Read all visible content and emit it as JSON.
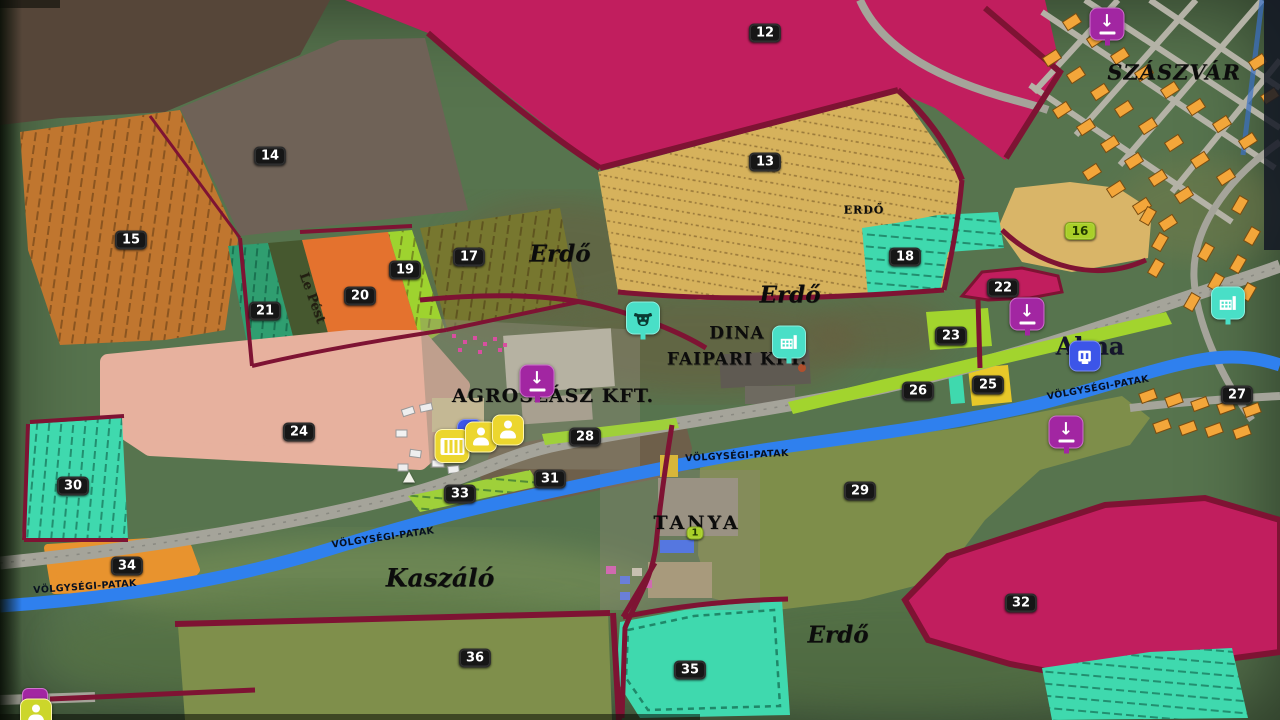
{
  "map": {
    "town": "SZÁSZVÁR",
    "labels": {
      "erdo_caps": "ERDŐ",
      "erdo": "Erdő",
      "dina_line1": "DINA",
      "dina_line2": "FAIPARI KFT.",
      "agroszasz": "AGROSZÁSZ KFT.",
      "alma": "Alma",
      "tanya": "TANYA",
      "kaszalo": "Kaszáló",
      "lepest": "Le Pést",
      "stream": "VÖLGYSÉGI-PATAK"
    },
    "badges": {
      "f12": "12",
      "f13": "13",
      "f14": "14",
      "f15": "15",
      "f16": "16",
      "f17": "17",
      "f18": "18",
      "f19": "19",
      "f20": "20",
      "f21": "21",
      "f22": "22",
      "f23": "23",
      "f24": "24",
      "f25": "25",
      "f26": "26",
      "f27": "27",
      "f28": "28",
      "f29": "29",
      "f30": "30",
      "f31": "31",
      "f32": "32",
      "f33": "33",
      "f34": "34",
      "f35": "35",
      "f36": "36",
      "farm1": "1"
    },
    "glyphs": {
      "sell_arrow": "↓"
    },
    "icons": {
      "sell_point": "purple-sell-point",
      "cow_pasture": "cow-pasture",
      "factory": "factory-sawmill",
      "production": "blue-production",
      "workshop": "vehicle-workshop",
      "worker": "hired-worker",
      "player": "player-marker"
    },
    "colors": {
      "badge-bg": "#161616",
      "badge-fg": "#ffffff",
      "owned-bg": "#a9cf28",
      "owned-fg": "#223a00",
      "sell": "#a226a2",
      "poi-teal": "#49dfc7",
      "poi-blue": "#3c55e8",
      "poi-yellow": "#ecd62e",
      "field-magenta": "#c11e5e",
      "border-maroon": "#7e1333",
      "road": "#a5a49a",
      "stream": "#2f80ee",
      "house": "#f3a63a"
    }
  }
}
